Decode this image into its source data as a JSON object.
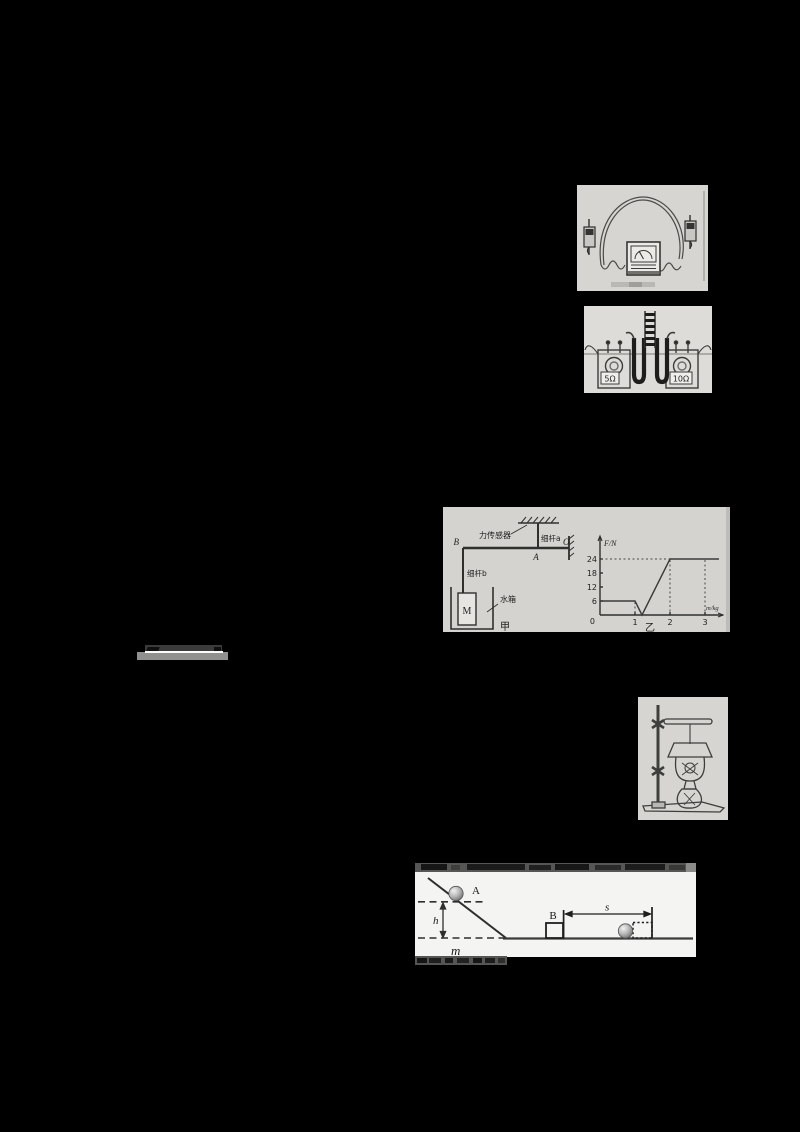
{
  "page": {
    "background": "#000000"
  },
  "fig_joule": {
    "left_resistor_label": "5Ω",
    "right_resistor_label": "10Ω"
  },
  "fig_lever": {
    "sensor_label": "力传感器",
    "rod_a_label": "细杆a",
    "rod_b_label": "细杆b",
    "tank_label": "水箱",
    "block_label": "M",
    "point_b": "B",
    "point_a": "A",
    "point_o": "O",
    "caption": "甲"
  },
  "fig_graph": {
    "y_axis_label": "F/N",
    "tick_24": "24",
    "tick_18": "18",
    "tick_12": "12",
    "tick_6": "6",
    "origin": "0",
    "tick_x1": "1",
    "tick_x2": "2",
    "tick_x3": "3",
    "x_axis_label": "m/kg",
    "caption": "乙"
  },
  "fig_incline": {
    "ball_label": "A",
    "block_label": "B",
    "height_label": "h",
    "mass_label": "m",
    "distance_label": "s"
  },
  "chart_data": {
    "type": "line",
    "title": "",
    "xlabel": "m/kg",
    "ylabel": "F/N",
    "xlim": [
      0,
      3.4
    ],
    "ylim": [
      0,
      27
    ],
    "x_ticks": [
      1,
      2,
      3
    ],
    "y_ticks": [
      6,
      12,
      18,
      24
    ],
    "grid": false,
    "legend": "none",
    "series": [
      {
        "name": "F vs m",
        "points": [
          [
            0,
            6
          ],
          [
            1,
            6
          ],
          [
            1.2,
            0
          ],
          [
            2,
            24
          ],
          [
            3.4,
            24
          ]
        ]
      }
    ],
    "dotted_guides": {
      "horizontal_at_F": 24,
      "vertical_at_m": [
        1,
        2,
        3
      ]
    },
    "captions": [
      "甲",
      "乙"
    ]
  }
}
